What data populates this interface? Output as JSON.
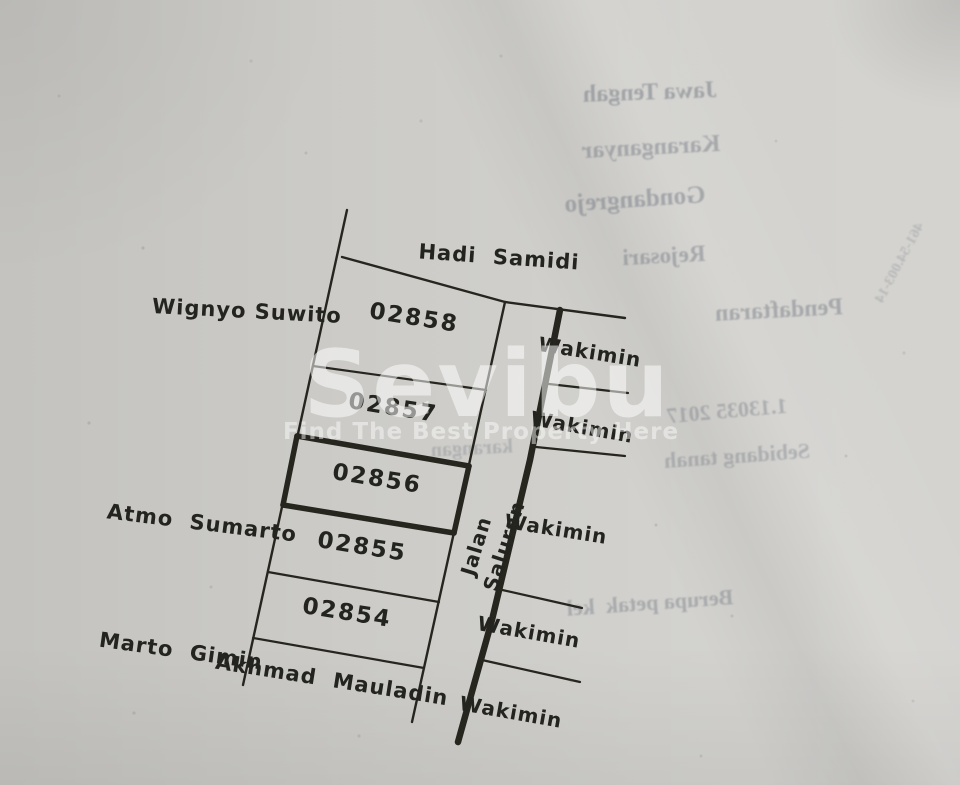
{
  "watermark": {
    "brand": "Sevibu",
    "tagline": "Find The Best Property Here"
  },
  "sketch": {
    "north_neighbor": "Hadi  Samidi",
    "west_neighbors": [
      "Wignyo Suwito",
      "Atmo  Sumarto",
      "Marto  Gimin"
    ],
    "south_neighbor": "Akhmad  Mauladin",
    "road_label": "Jalan",
    "canal_label": "Saluran",
    "plot_numbers": [
      "02858",
      "02857",
      "02856",
      "02855",
      "02854"
    ],
    "east_neighbors": [
      "Wakimin",
      "Wakimin",
      "Wakimin",
      "Wakimin",
      "Wakimin"
    ],
    "highlighted_plot": "02856"
  },
  "bleed_through": {
    "lines": [
      "Jawa Tengah",
      "Karanganyar",
      "Gondangrejo",
      "Rejosari",
      "Pendaftaran",
      "1.13035 2017",
      "Sebidang tanah",
      "karangan",
      "Berupa petak  kel",
      "461-54.003-14"
    ]
  }
}
